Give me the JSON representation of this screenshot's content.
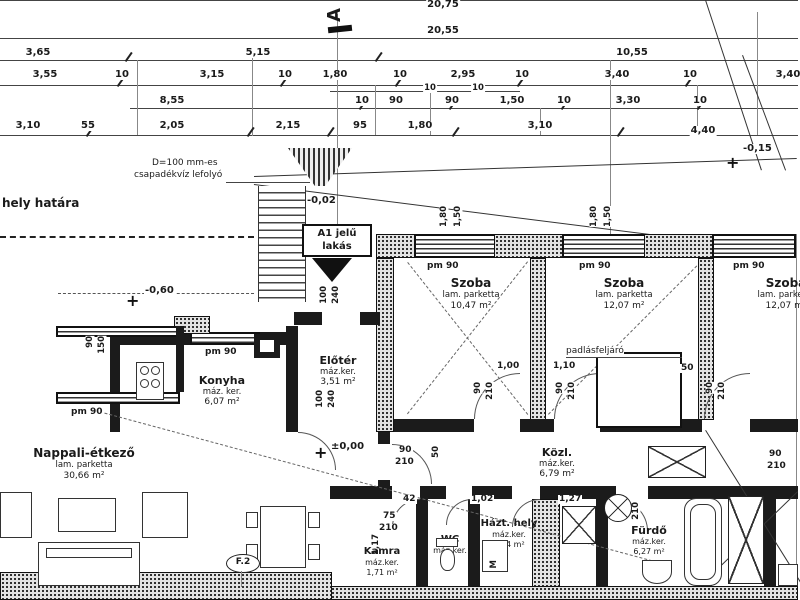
{
  "dims": {
    "t1": "20,75",
    "t2": "20,55",
    "r3": [
      "3,65",
      "5,15",
      "10,55"
    ],
    "r4": [
      "3,55",
      "10",
      "3,15",
      "10",
      "1,80",
      "10",
      "2,95",
      "10",
      "3,40",
      "10",
      "3,40"
    ],
    "r4b": [
      "10",
      "10"
    ],
    "r5": [
      "8,55",
      "10",
      "90",
      "90",
      "1,50",
      "10",
      "3,30",
      "10"
    ],
    "r6": [
      "3,10",
      "55",
      "2,05",
      "2,15",
      "95",
      "1,80",
      "3,10",
      "4,40"
    ],
    "site_level": "-0,15"
  },
  "levels": {
    "entry": "-0,02",
    "terrace": "-0,60",
    "floor": "±0,00"
  },
  "marks": {
    "section": "A",
    "f2": "F.2",
    "wm": "M",
    "sill": "pm 90"
  },
  "notes": {
    "boundary": "hely határa",
    "drain1": "D=100 mm-es",
    "drain2": "csapadékvíz lefolyó",
    "apt1": "A1 jelű",
    "apt2": "lakás",
    "attic": "padlásfeljáró"
  },
  "win": {
    "w180": "1,80",
    "h150": "1,50",
    "w90": "90",
    "h150b": "150"
  },
  "door": {
    "w90": "90",
    "h210": "210",
    "w100": "100",
    "h240": "240",
    "w75": "75"
  },
  "d": {
    "a": "1,00",
    "b": "1,10",
    "c": "50",
    "e": "42",
    "f": "1,02",
    "g": "1,27",
    "h": "1,17"
  },
  "rooms": [
    {
      "name": "Szoba",
      "fin": "lam. parketta",
      "area": "10,47 m²"
    },
    {
      "name": "Szoba",
      "fin": "lam. parketta",
      "area": "12,07 m²"
    },
    {
      "name": "Szoba",
      "fin": "lam. parketta",
      "area": "12,07 m²"
    },
    {
      "name": "Konyha",
      "fin": "máz. ker.",
      "area": "6,07 m²"
    },
    {
      "name": "Előtér",
      "fin": "máz.ker.",
      "area": "3,51 m²"
    },
    {
      "name": "Nappali-étkező",
      "fin": "lam. parketta",
      "area": "30,66 m²"
    },
    {
      "name": "Közl.",
      "fin": "máz.ker.",
      "area": "6,79 m²"
    },
    {
      "name": "Kamra",
      "fin": "máz.ker.",
      "area": "1,71 m²"
    },
    {
      "name": "WC",
      "fin": "máz.ker.",
      "area": ""
    },
    {
      "name": "Házt. hely",
      "fin": "máz.ker.",
      "area": "3,04 m²"
    },
    {
      "name": "Fürdő",
      "fin": "máz.ker.",
      "area": "6,27 m²"
    }
  ]
}
